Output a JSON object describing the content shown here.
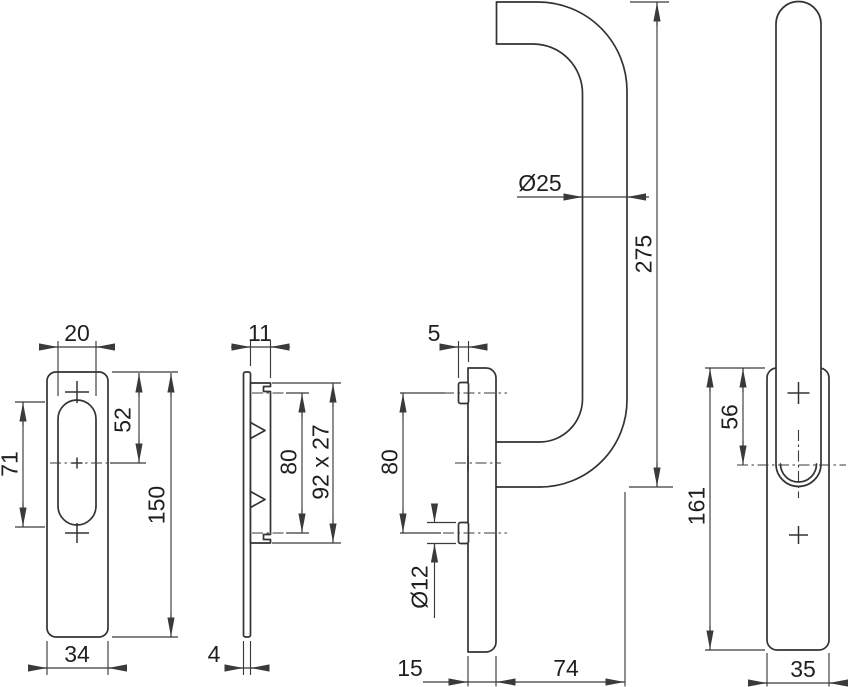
{
  "views": {
    "plate_front": {
      "slot_width": "20",
      "slot_height": "71",
      "hole_offset": "52",
      "height": "150",
      "width": "34"
    },
    "plate_side": {
      "depth": "11",
      "hole_spacing": "80",
      "boss_size": "92 x 27",
      "thickness": "4"
    },
    "handle_side": {
      "boss_offset": "5",
      "hole_spacing": "80",
      "boss_diameter": "Ø12",
      "tube_diameter": "Ø25",
      "height": "275",
      "plate_depth": "15",
      "projection": "74"
    },
    "handle_front": {
      "hole_offset": "56",
      "plate_height": "161",
      "plate_width": "35"
    }
  },
  "colors": {
    "background": "#ffffff",
    "line": "#333333",
    "dimension_line": "#3a3a3a",
    "text": "#1f1f1f"
  }
}
